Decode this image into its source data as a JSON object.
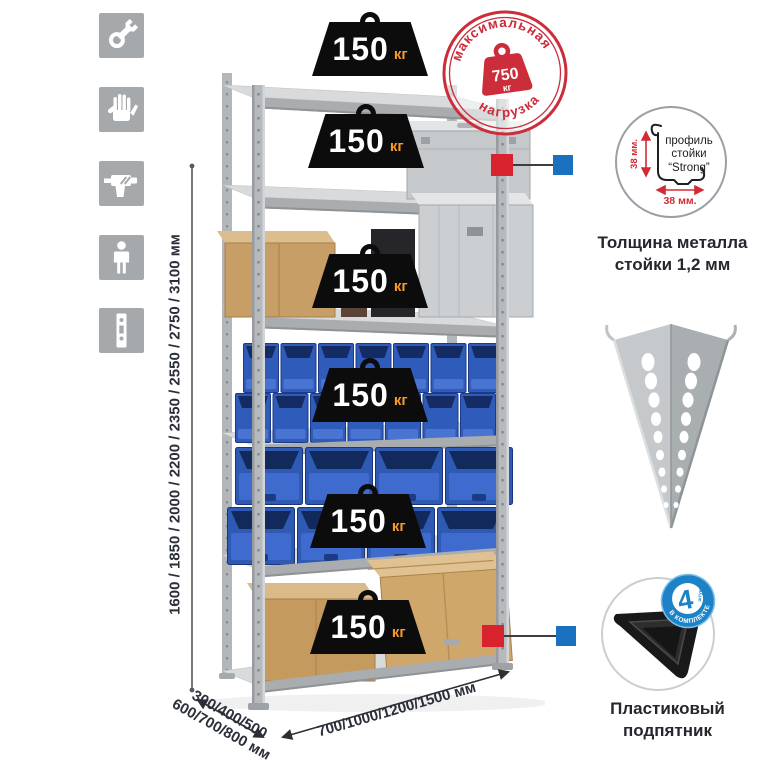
{
  "assembly_icons": {
    "bg_color": "#a6a9ab",
    "items": [
      {
        "name": "wrench"
      },
      {
        "name": "gloves"
      },
      {
        "name": "drill"
      },
      {
        "name": "person"
      },
      {
        "name": "post-profile"
      }
    ]
  },
  "dimensions": {
    "heights": "1600 / 1850 / 2000 / 2200 / 2350 / 2550 / 2750 / 3100 мм",
    "depths_line1": "300/400/500",
    "depths_line2": "600/700/800 мм",
    "widths": "700/1000/1200/1500 мм"
  },
  "shelves": [
    {
      "load": "150",
      "unit": "кг"
    },
    {
      "load": "150",
      "unit": "кг"
    },
    {
      "load": "150",
      "unit": "кг"
    },
    {
      "load": "150",
      "unit": "кг"
    },
    {
      "load": "150",
      "unit": "кг"
    },
    {
      "load": "150",
      "unit": "кг"
    }
  ],
  "max_load_stamp": {
    "arc_top": "максимальная",
    "arc_bottom": "нагрузка",
    "weight_value": "750",
    "weight_unit": "кг"
  },
  "profile_callout": {
    "label_line1": "профиль",
    "label_line2": "стойки",
    "label_line3": "“Strong”",
    "dim_vertical": "38 мм.",
    "dim_horizontal": "38 мм.",
    "caption_line1": "Толщина металла",
    "caption_line2": "стойки 1,2 мм"
  },
  "foot_callout": {
    "badge_value": "4",
    "badge_unit": "штуки",
    "badge_arc": "в комплекте",
    "caption_line1": "Пластиковый",
    "caption_line2": "подпятник"
  },
  "colors": {
    "stamp_red": "#cb2d3a",
    "callout_red": "#d8232e",
    "callout_blue": "#1a71c0",
    "badge_blue": "#1d83c6",
    "dim_text": "#2b2f3a",
    "bin_blue": "#2f5cbb"
  }
}
